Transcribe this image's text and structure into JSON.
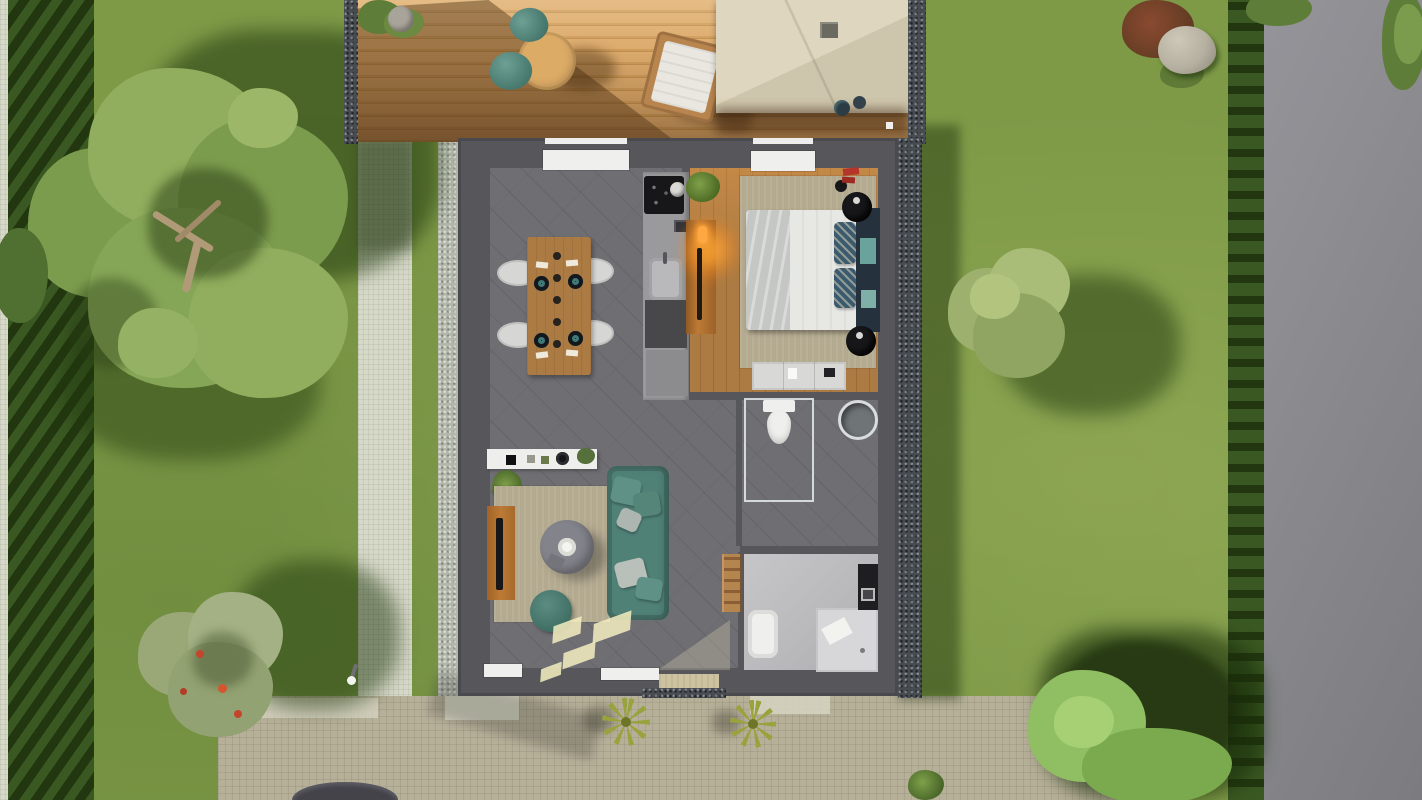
{
  "meta": {
    "description": "Top-down 3D architectural rendering of a small single-storey house with garden, wooden deck, stone paths, paved driveway and a road on the right. No text is visible in the image.",
    "view": "bird's-eye / floor-plan render"
  },
  "colors": {
    "grass": "#7e9a47",
    "grass-light": "#93a855",
    "road": "#8a8a8e",
    "path": "#d7d9c8",
    "paving": "#b7b099",
    "paving-light": "#d6d5c2",
    "gravel": "#474c52",
    "gravel-light": "#b2b7aa",
    "hedge": "#3a5822",
    "hedge-dark": "#22370f",
    "deck": "#d2a261",
    "deck-dark": "#7c5530",
    "pergola": "#d9d1b8",
    "pergola-dark": "#c7bfa5",
    "wall": "#57575b",
    "floor": "#6f6e73",
    "wood": "#ac7b43",
    "rug": "#b4aa90",
    "white": "#efefed",
    "bed-gray": "#c5c7c5",
    "teal": "#4f8177",
    "teal-dark": "#3c6b61",
    "navy": "#25313c",
    "counter": "#9a9a9c",
    "counter-dark": "#48484a",
    "black": "#17171a",
    "orange-wood": "#bd7a35",
    "glow": "#ffa843",
    "marble": "#bdbdbf",
    "shower": "#d7d7d9",
    "mat": "#cdc3a0",
    "sun": "#f5eec0",
    "red": "#b5352b",
    "rock": "#b5b0a0",
    "car": "#44434a",
    "leaf": "#7c9c4d",
    "leaf-light": "#90ae5d",
    "leaf-dark": "#5e7d39",
    "leaf-gray": "#9aa878",
    "palm": "#99a33d",
    "trunk": "#b19a77"
  },
  "scene": {
    "garden": {
      "elements": [
        "lawn",
        "left-stone-path",
        "left-hedge",
        "right-boundary-hedge",
        "asphalt-road",
        "vertical-stone-path",
        "paved-driveway",
        "car-roof-at-bottom-edge",
        "garden-bollard-light",
        "rock",
        "red-shrub",
        "small-bushes"
      ],
      "trees": [
        "large-tree-top-left",
        "fruit-tree-bottom-left",
        "tree-right-of-house",
        "trees-bottom-right",
        "canopy-top-right-corner"
      ]
    },
    "deck": {
      "furniture": [
        "planter",
        "round-bistro-table",
        "teal-chair",
        "teal-chair",
        "sun-lounger-with-white-cushion",
        "pergola-canopy-with-vent",
        "potted-plants"
      ]
    },
    "house": {
      "rooms": [
        {
          "name": "dining-area",
          "items": [
            "wooden-dining-table",
            "four-white-chairs",
            "four-place-settings",
            "table-runner",
            "window-top"
          ]
        },
        {
          "name": "kitchen",
          "items": [
            "black-cooktop",
            "pot",
            "small-appliance",
            "sink-with-faucet",
            "base-cabinets"
          ]
        },
        {
          "name": "bedroom",
          "items": [
            "double-bed",
            "gray-duvet",
            "patterned-pillows",
            "dark-headboard-with-teal-panels",
            "round-black-nightstands",
            "dresser",
            "orange-wardrobe-with-lamp",
            "potted-plant",
            "red-decor",
            "area-rug",
            "window-top"
          ]
        },
        {
          "name": "wc",
          "items": [
            "toilet",
            "round-washbasin",
            "glass-partition"
          ]
        },
        {
          "name": "bathroom",
          "items": [
            "bathtub",
            "walk-in-shower-with-towel",
            "dark-vanity-with-sink",
            "wooden-towel-ladder"
          ]
        },
        {
          "name": "living-room",
          "items": [
            "teal-sofa-with-cushions",
            "round-coffee-table-with-bowl",
            "teal-pouf",
            "area-rug",
            "white-sideboard-with-decor",
            "orange-tv-bench-with-tv",
            "potted-plants",
            "sunlight-patches",
            "bottom-windows",
            "entrance-door-mat"
          ]
        }
      ]
    }
  }
}
